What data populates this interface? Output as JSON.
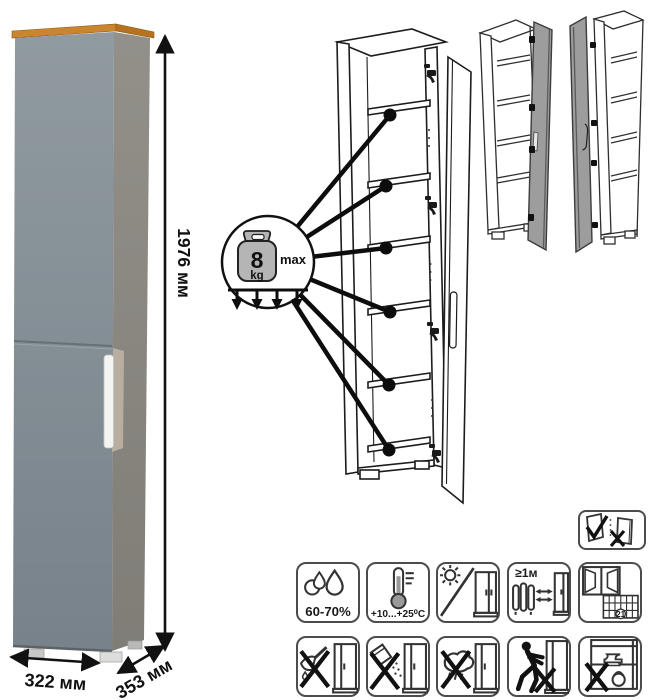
{
  "product_view": {
    "height_label": "1976 мм",
    "width_label": "322 мм",
    "depth_label": "353 мм"
  },
  "load_callout": {
    "value": "8",
    "unit": "kg",
    "qualifier": "max",
    "icon": "kettlebell-weight-icon"
  },
  "door_variants": {
    "left_drawing": "door-hinged-right-variant",
    "right_drawing": "door-hinged-left-variant"
  },
  "door_reversibility": {
    "icon": "door-ok-door-x-icon"
  },
  "care_grid": {
    "row1": [
      {
        "name": "humidity-icon",
        "label": "60-70%"
      },
      {
        "name": "temperature-icon",
        "label": "+10...+25⁰C"
      },
      {
        "name": "no-direct-sunlight-icon",
        "label": ""
      },
      {
        "name": "heat-distance-icon",
        "label": "≥1м"
      },
      {
        "name": "ventilation-calendar-icon",
        "label": "21"
      }
    ],
    "row2": [
      {
        "name": "no-sharp-tools-icon"
      },
      {
        "name": "no-abrasive-cleaners-icon"
      },
      {
        "name": "no-wet-cleaning-icon"
      },
      {
        "name": "do-not-push-icon"
      },
      {
        "name": "do-not-overload-icon"
      }
    ]
  },
  "colors": {
    "cabinet_front": "#8C959B",
    "cabinet_side": "#8F8C86",
    "cabinet_top_wood": "#C9862E",
    "handle": "#F4F4F2",
    "variant_door_gray": "#9D9D9D",
    "line_art": "#1C1C1C"
  }
}
